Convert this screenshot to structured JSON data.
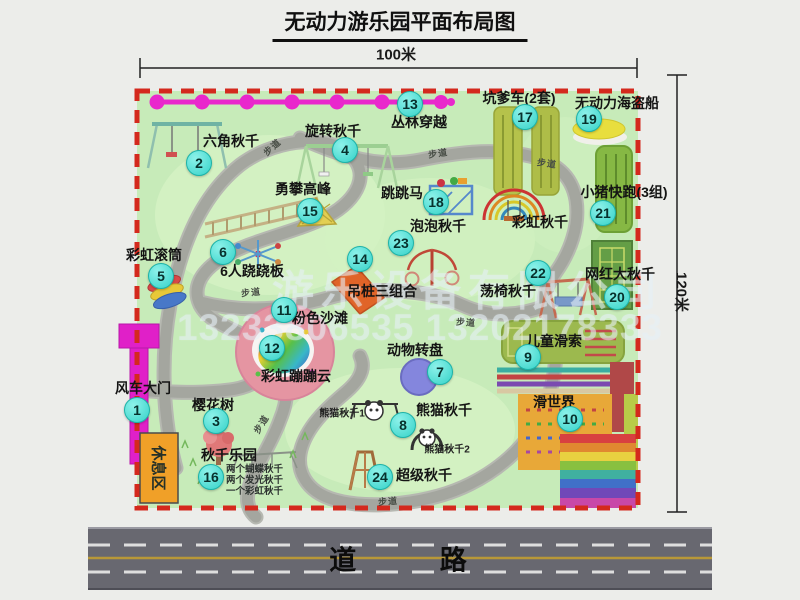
{
  "title": "无动力游乐园平面布局图",
  "dimension_width": "100米",
  "dimension_height": "120米",
  "road_label": "道 路",
  "rest_area_label": "休息区",
  "path_label": "步道",
  "watermark": {
    "company": "游乐设备有限公司",
    "phones": "13233806535 13202178333"
  },
  "attractions": [
    {
      "num": "1",
      "label": "风车大门"
    },
    {
      "num": "2",
      "label": "六角秋千"
    },
    {
      "num": "3",
      "label": "樱花树"
    },
    {
      "num": "4",
      "label": "旋转秋千"
    },
    {
      "num": "5",
      "label": "彩虹滚筒"
    },
    {
      "num": "6",
      "label": "6人跷跷板"
    },
    {
      "num": "7",
      "label": "动物转盘"
    },
    {
      "num": "8",
      "label": "熊猫秋千"
    },
    {
      "num": "9",
      "label": "儿童滑索"
    },
    {
      "num": "10",
      "label": "滑世界"
    },
    {
      "num": "11",
      "label": "粉色沙滩"
    },
    {
      "num": "12",
      "label": "彩虹蹦蹦云"
    },
    {
      "num": "13",
      "label": "丛林穿越"
    },
    {
      "num": "14",
      "label": "吊桩三组合"
    },
    {
      "num": "15",
      "label": "勇攀高峰"
    },
    {
      "num": "16",
      "label": "秋千乐园"
    },
    {
      "num": "17",
      "label": "坑爹车(2套)"
    },
    {
      "num": "18",
      "label": "跳跳马"
    },
    {
      "num": "19",
      "label": "无动力海盗船"
    },
    {
      "num": "20",
      "label": "网红大秋千"
    },
    {
      "num": "21",
      "label": "小猪快跑(3组)"
    },
    {
      "num": "22",
      "label": "荡椅秋千"
    },
    {
      "num": "23",
      "label": "泡泡秋千"
    },
    {
      "num": "24",
      "label": "超级秋千"
    }
  ],
  "extra_labels": [
    "彩虹秋千",
    "熊猫秋千1",
    "熊猫秋千2"
  ],
  "swing_park_details": [
    "两个蝴蝶秋千",
    "两个发光秋千",
    "一个彩虹秋千"
  ],
  "colors": {
    "map_green": "#c7ebb9",
    "border_red": "#d4291d",
    "badge_teal": "#3edcd2",
    "zipline_magenta": "#e928cc",
    "gate_magenta": "#e020c8",
    "rest_area_orange": "#f0a028",
    "road_gray": "#686870"
  }
}
